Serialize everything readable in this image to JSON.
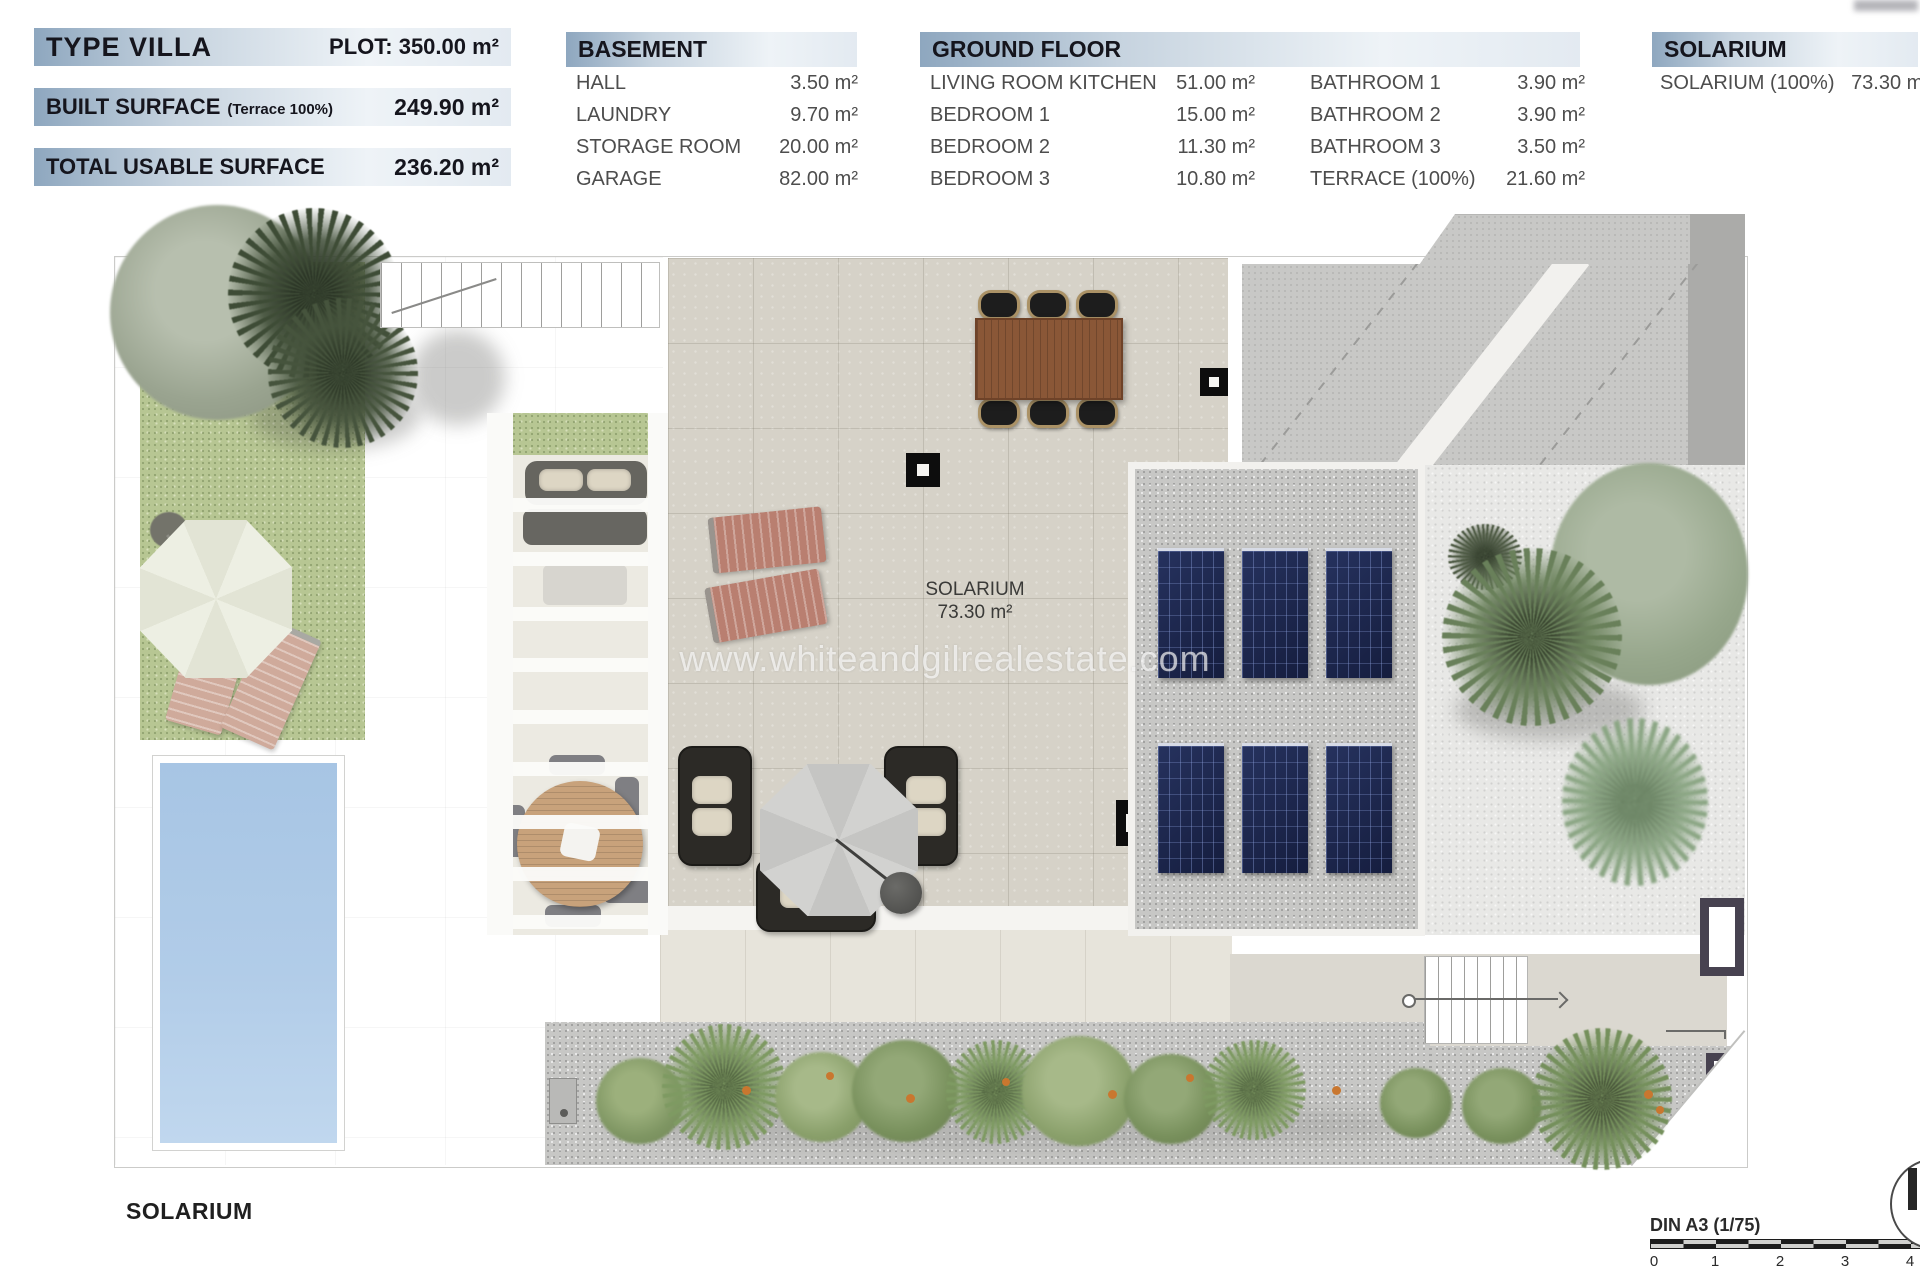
{
  "summary": {
    "type_label": "TYPE VILLA",
    "plot": "PLOT: 350.00 m²",
    "built_surface_label": "BUILT SURFACE",
    "built_surface_note": "(Terrace 100%)",
    "built_surface_value": "249.90 m²",
    "total_usable_label": "TOTAL USABLE SURFACE",
    "total_usable_value": "236.20 m²"
  },
  "basement": {
    "title": "BASEMENT",
    "rows": [
      {
        "label": "HALL",
        "value": "3.50 m²"
      },
      {
        "label": "LAUNDRY",
        "value": "9.70 m²"
      },
      {
        "label": "STORAGE ROOM",
        "value": "20.00 m²"
      },
      {
        "label": "GARAGE",
        "value": "82.00 m²"
      }
    ]
  },
  "ground_floor": {
    "title": "GROUND FLOOR",
    "col1": [
      {
        "label": "LIVING ROOM KITCHEN",
        "value": "51.00 m²"
      },
      {
        "label": "BEDROOM 1",
        "value": "15.00 m²"
      },
      {
        "label": "BEDROOM 2",
        "value": "11.30 m²"
      },
      {
        "label": "BEDROOM 3",
        "value": "10.80 m²"
      }
    ],
    "col2": [
      {
        "label": "BATHROOM 1",
        "value": "3.90 m²"
      },
      {
        "label": "BATHROOM 2",
        "value": "3.90 m²"
      },
      {
        "label": "BATHROOM 3",
        "value": "3.50 m²"
      },
      {
        "label": "TERRACE (100%)",
        "value": "21.60 m²"
      }
    ]
  },
  "solarium_table": {
    "title": "SOLARIUM",
    "rows": [
      {
        "label": "SOLARIUM (100%)",
        "value": "73.30 m²"
      }
    ]
  },
  "plan": {
    "room_label": "SOLARIUM",
    "room_area": "73.30 m²",
    "watermark": "www.whiteandgilrealestate.com",
    "floor_caption": "SOLARIUM"
  },
  "scale_bar": {
    "label": "DIN A3 (1/75)",
    "ticks": [
      "0",
      "1",
      "2",
      "3",
      "4"
    ]
  },
  "colors": {
    "header_gradient_start": "#8ea7bf",
    "header_text": "#15151d",
    "row_text": "#4d4d4d",
    "pool_water": "#aecbe8",
    "solar_panel": "#192349",
    "grass": "#b7c693",
    "terrace_tile": "#d6d2c8",
    "gravel": "#c7c7c5"
  }
}
